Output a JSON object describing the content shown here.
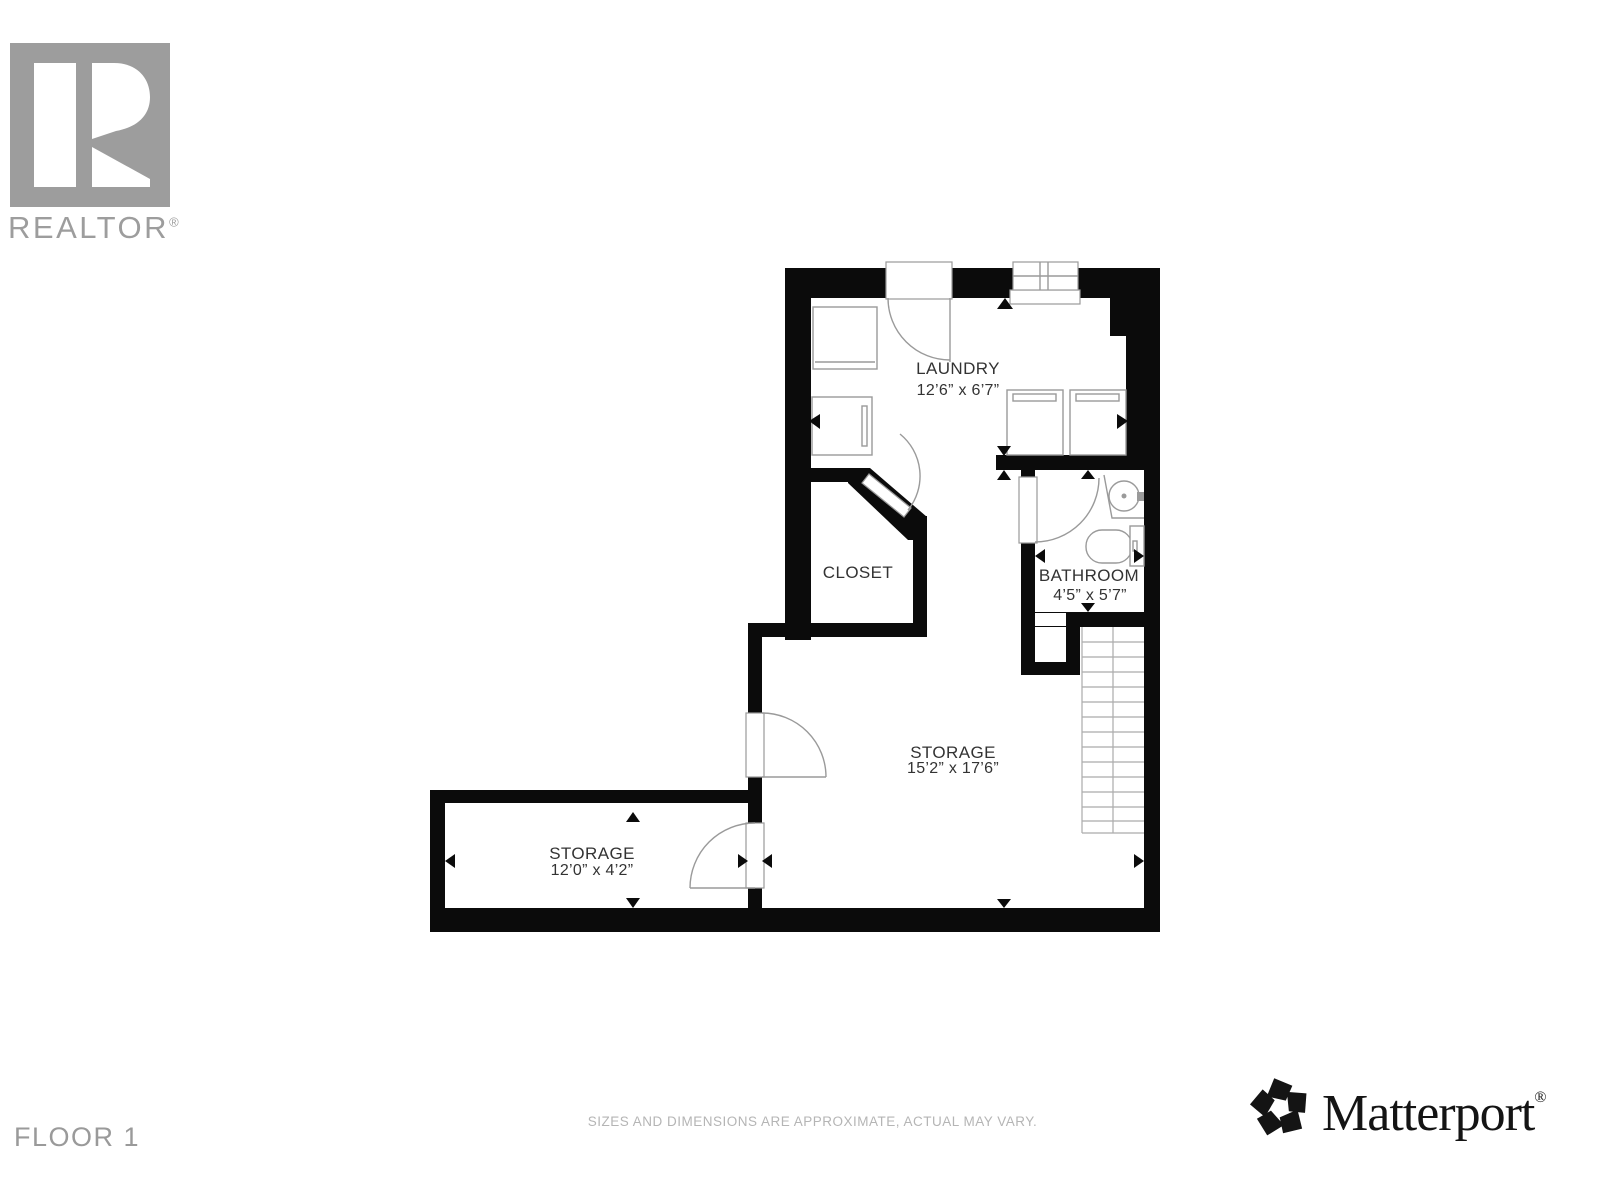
{
  "branding": {
    "realtor": {
      "wordmark": "REALTOR",
      "registered_mark": "®"
    },
    "matterport": {
      "wordmark": "Matterport",
      "registered_mark": "®"
    }
  },
  "floor": {
    "label": "FLOOR 1"
  },
  "footer": {
    "disclaimer": "SIZES AND DIMENSIONS ARE APPROXIMATE, ACTUAL MAY VARY."
  },
  "rooms": {
    "laundry": {
      "name": "LAUNDRY",
      "dimensions": "12’6” x 6’7”"
    },
    "closet": {
      "name": "CLOSET",
      "dimensions": ""
    },
    "bathroom": {
      "name": "BATHROOM",
      "dimensions": "4’5” x 5’7”"
    },
    "storage_main": {
      "name": "STORAGE",
      "dimensions": "15’2” x 17’6”"
    },
    "storage_small": {
      "name": "STORAGE",
      "dimensions": "12’0” x 4’2”"
    }
  },
  "colors": {
    "wall": "#0b0b0b",
    "fixture_line": "#9a9a9a",
    "room_label": "#333333",
    "logo_gray": "#9d9d9d",
    "muted_text": "#b5b5b5",
    "matterport_black": "#141414"
  }
}
